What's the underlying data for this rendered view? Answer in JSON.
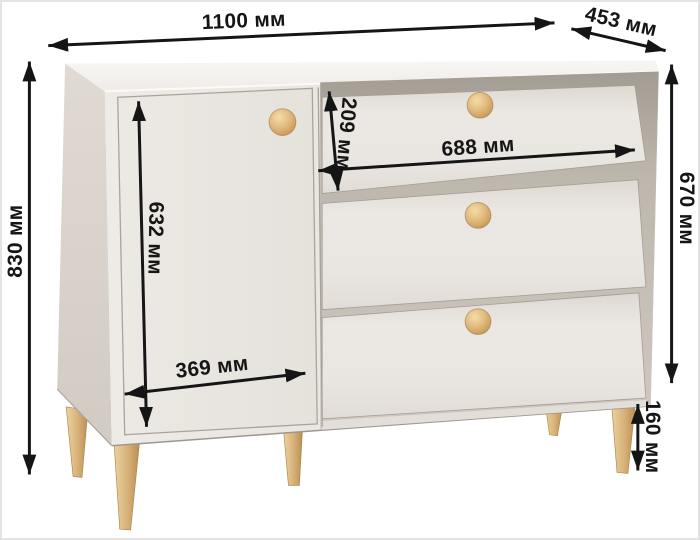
{
  "figure": {
    "title": "Chest of drawers dimensions diagram",
    "product": "chest-of-drawers-with-door-and-3-drawers",
    "unit": "мм",
    "dimensions": {
      "overall_width": {
        "value": 1100,
        "label": "1100 мм"
      },
      "depth": {
        "value": 453,
        "label": "453 мм"
      },
      "overall_height": {
        "value": 830,
        "label": "830 мм"
      },
      "body_height": {
        "value": 670,
        "label": "670 мм"
      },
      "door_height": {
        "value": 632,
        "label": "632 мм"
      },
      "door_width": {
        "value": 369,
        "label": "369 мм"
      },
      "top_drawer_height": {
        "value": 209,
        "label": "209 мм"
      },
      "drawer_width": {
        "value": 688,
        "label": "688 мм"
      },
      "leg_height": {
        "value": 160,
        "label": "160 мм"
      }
    },
    "colors": {
      "body_front": "#e9e5e0",
      "body_side": "#dbd5ce",
      "top_surface": "#f4f1ee",
      "drawer_slot_shadow": "#a8a198",
      "wood_knob": "#e3bd82",
      "wood_leg": "#d9b47b",
      "dimension_lines": "#151515",
      "background": "#ffffff"
    }
  }
}
